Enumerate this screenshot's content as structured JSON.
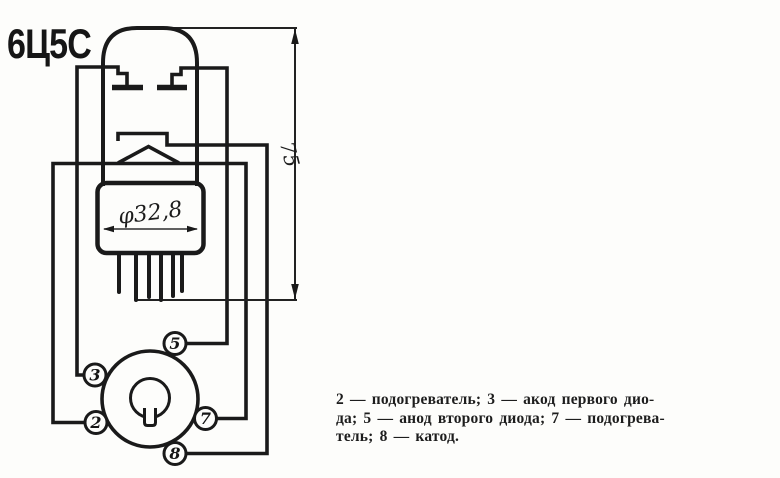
{
  "title": "6Ц5С",
  "dimensions": {
    "height": "75",
    "diameter": "φ32,8"
  },
  "socket": {
    "pins": [
      {
        "label": "5"
      },
      {
        "label": "3"
      },
      {
        "label": "2"
      },
      {
        "label": "7"
      },
      {
        "label": "8"
      }
    ]
  },
  "legend": {
    "lines": [
      "2 — подогреватель; 3 — акод первого дио-",
      "да; 5 — анод второго диода; 7 — подогрева-",
      "тель; 8 — катод."
    ]
  },
  "colors": {
    "ink": "#1a1a1a",
    "paper": "#fdfdfb"
  }
}
